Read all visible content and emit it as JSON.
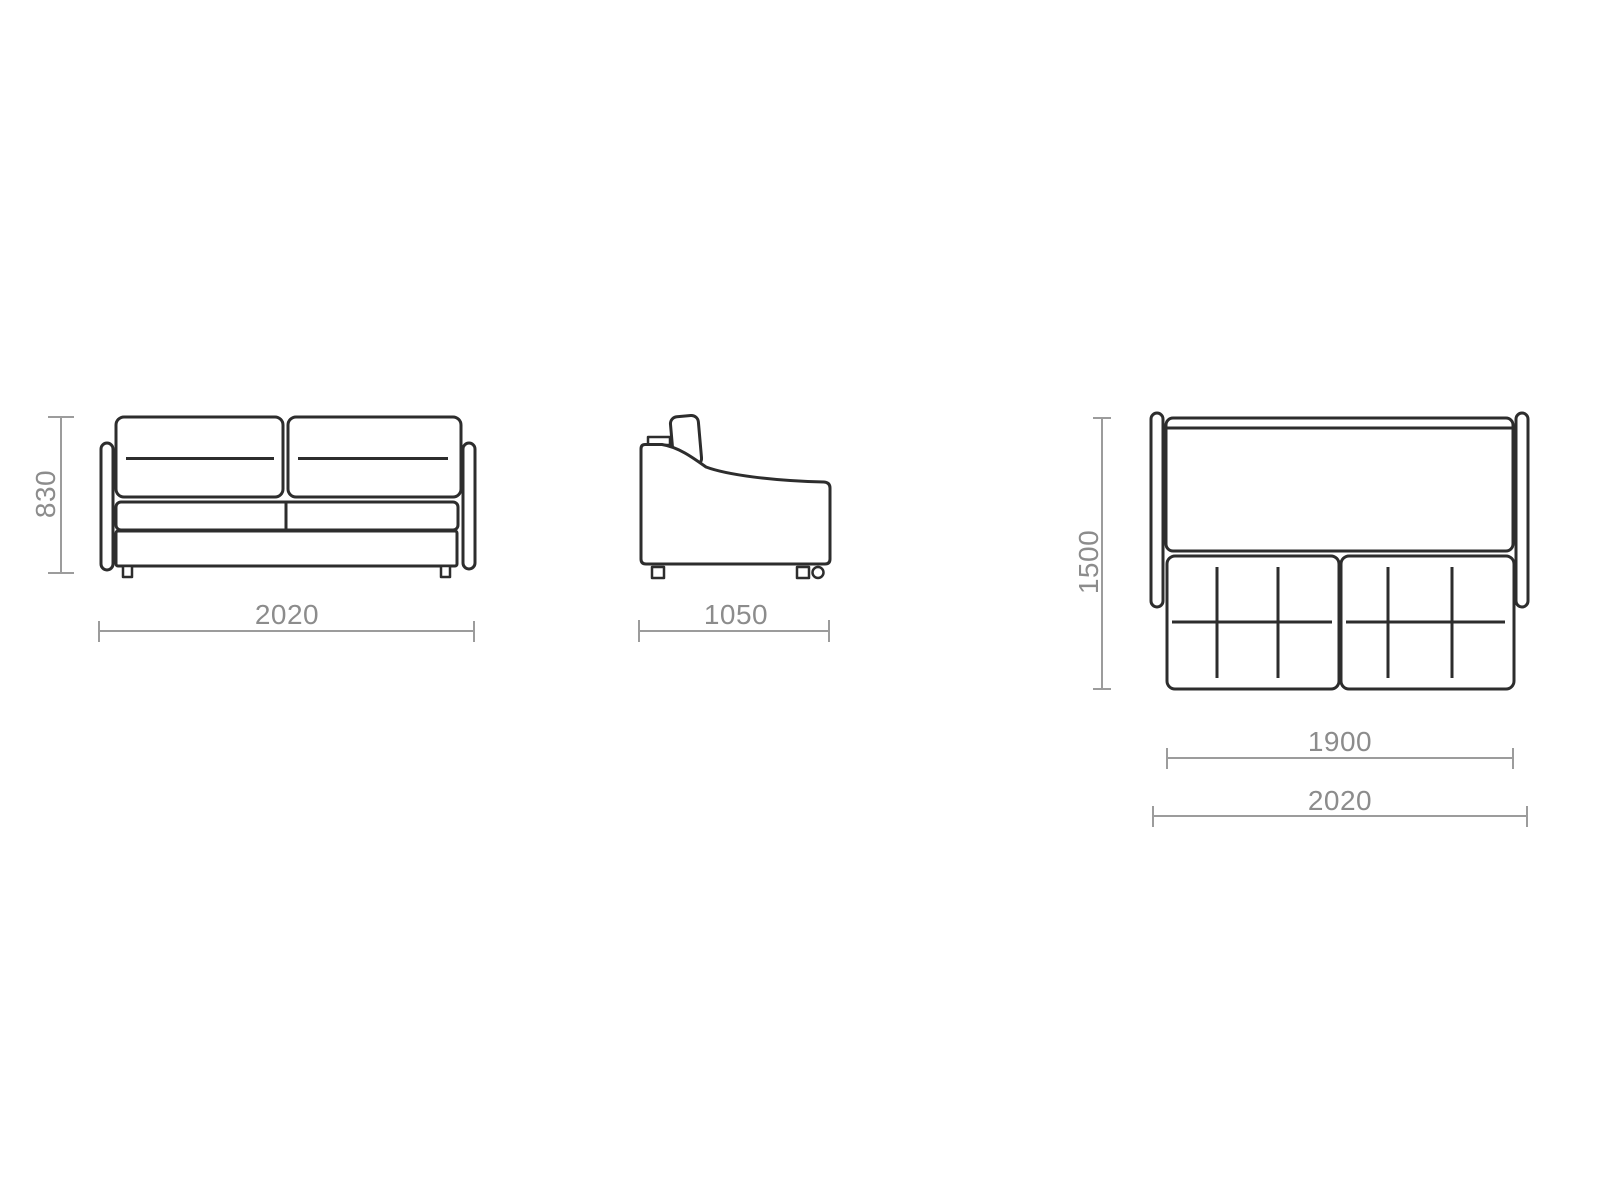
{
  "colors": {
    "background": "#ffffff",
    "outline": "#2d2d2d",
    "dimension_line": "#9c9c9c",
    "dimension_text": "#8c8c8c"
  },
  "dimensions": {
    "front_height": "830",
    "front_width": "2020",
    "side_depth": "1050",
    "bed_depth": "1500",
    "bed_width": "1900",
    "overall_width": "2020"
  }
}
